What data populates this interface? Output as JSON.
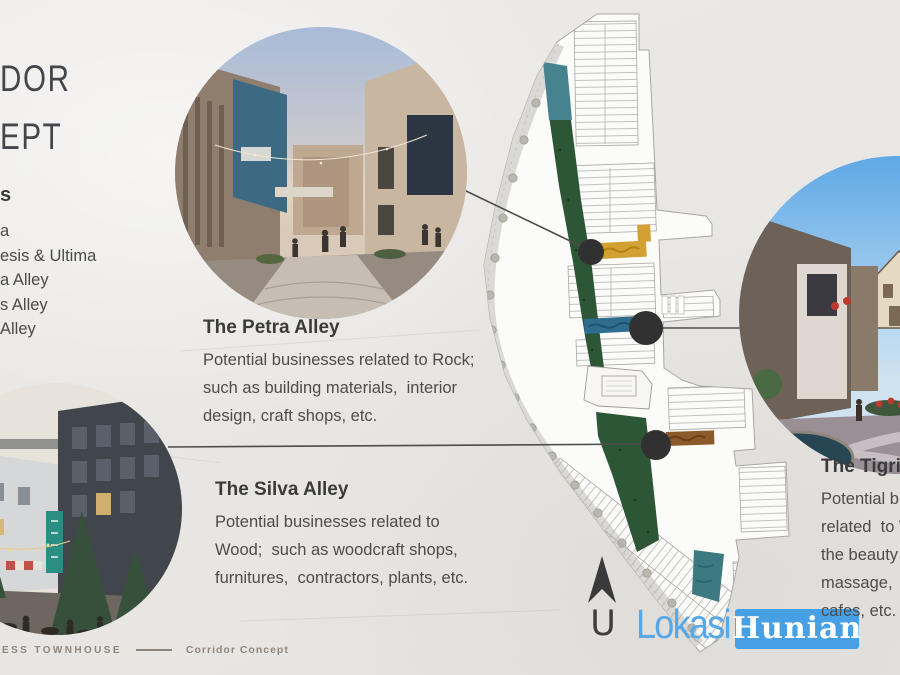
{
  "slide": {
    "title_lines": [
      "DOR",
      "EPT"
    ],
    "legend": {
      "heading": "s",
      "items": [
        "a",
        "esis & Ultima",
        "a Alley",
        "s Alley",
        "Alley"
      ]
    },
    "callouts": {
      "petra": {
        "heading": "The Petra Alley",
        "lines": [
          "Potential businesses related to Rock;",
          "such as building materials,  interior",
          "design, craft shops, etc."
        ]
      },
      "silva": {
        "heading": "The Silva Alley",
        "lines": [
          "Potential businesses related to",
          "Wood;  such as woodcraft shops,",
          "furnitures,  contractors, plants, etc."
        ]
      },
      "tigris": {
        "heading": "The Tigris",
        "lines": [
          "Potential bu",
          "related  to W",
          "the beauty",
          "massage,  r",
          "cafes, etc."
        ]
      }
    },
    "compass_label": "U",
    "footer": {
      "series": "ESS TOWNHOUSE",
      "section": "Corridor Concept"
    },
    "logo": {
      "word1": "Lokasi",
      "word2": "Hunian"
    },
    "colors": {
      "paper": "#eae8e5",
      "text_dark": "#3b3b3b",
      "text_body": "#4c4c4c",
      "logo_blue": "#47a0e4",
      "logo_text_blue": "#56a9e9",
      "map_green": "#2c5636",
      "map_teal": "#47838e",
      "alley_gold": "#d2a033",
      "alley_blue": "#2e6d8e",
      "alley_brown": "#8a5a2a",
      "marker_black": "#313131"
    }
  }
}
